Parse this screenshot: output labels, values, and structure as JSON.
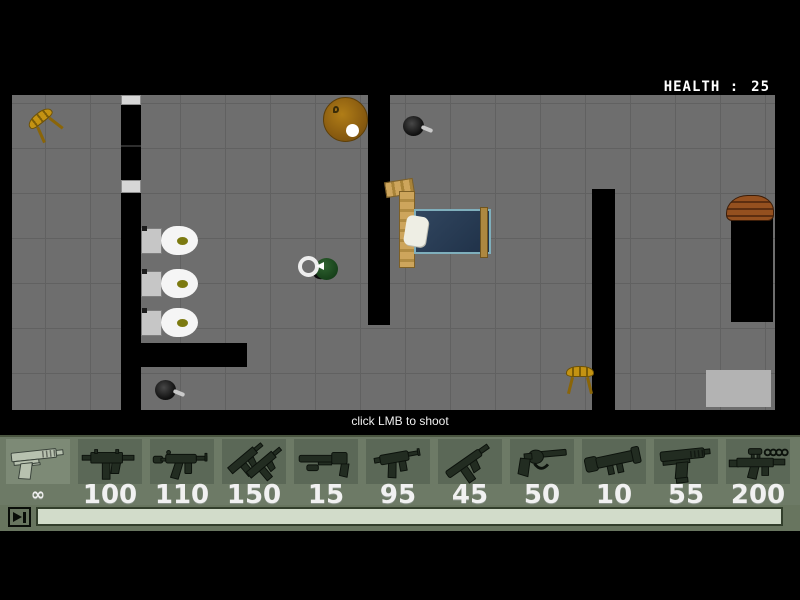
{
  "hud": {
    "health_label": "HEALTH :",
    "health_value": "25"
  },
  "hint_text": "click LMB to shoot",
  "weapon_bar": {
    "slots": [
      {
        "icon": "desert-eagle",
        "ammo": "∞",
        "selected": true
      },
      {
        "icon": "uzi",
        "ammo": "100",
        "selected": false
      },
      {
        "icon": "mp5",
        "ammo": "110",
        "selected": false
      },
      {
        "icon": "dual-uzi",
        "ammo": "150",
        "selected": false
      },
      {
        "icon": "sawnoff-shotgun",
        "ammo": "15",
        "selected": false
      },
      {
        "icon": "skorpion",
        "ammo": "95",
        "selected": false
      },
      {
        "icon": "tec9",
        "ammo": "45",
        "selected": false
      },
      {
        "icon": "revolver",
        "ammo": "50",
        "selected": false
      },
      {
        "icon": "rocket-launcher",
        "ammo": "10",
        "selected": false
      },
      {
        "icon": "auto-pistol",
        "ammo": "55",
        "selected": false
      },
      {
        "icon": "scoped-rifle",
        "ammo": "200",
        "selected": false
      }
    ]
  },
  "colors": {
    "floor": "#6e6e6e",
    "wall": "#000000",
    "bar_background": "#6d7a66",
    "slot_background": "#5b6857",
    "slot_selected_background": "#7d8a76",
    "scroll_track": "#d2dcca",
    "hud_text": "#ffffff"
  },
  "scene_objects": [
    "chair",
    "toilet",
    "round-table-lamp",
    "frying-pan",
    "bed",
    "player",
    "crate",
    "rug"
  ]
}
